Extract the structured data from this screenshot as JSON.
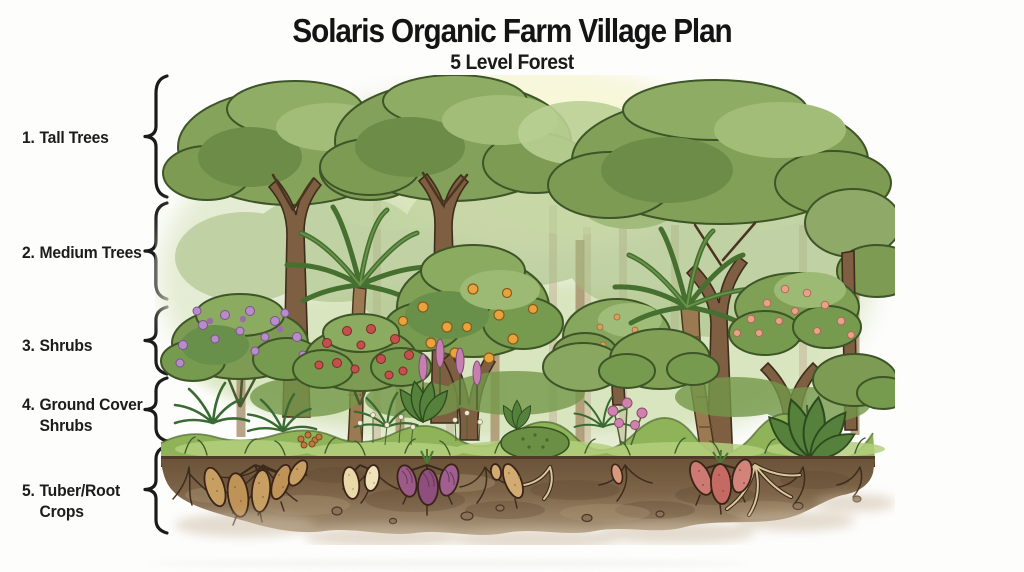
{
  "header": {
    "title": "Solaris Organic Farm Village Plan",
    "subtitle": "5 Level Forest"
  },
  "legend": {
    "items": [
      {
        "number": "1.",
        "lines": [
          "Tall Trees"
        ]
      },
      {
        "number": "2.",
        "lines": [
          "Medium Trees"
        ]
      },
      {
        "number": "3.",
        "lines": [
          "Shrubs"
        ]
      },
      {
        "number": "4.",
        "lines": [
          "Ground Cover",
          "Shrubs"
        ]
      },
      {
        "number": "5.",
        "lines": [
          "Tuber/Root",
          "Crops"
        ]
      }
    ]
  },
  "illustration": {
    "description": "Hand-drawn watercolor cross-section of a five level food forest: tall canopy trees, medium trees with palms and orange fruit tree, flowering shrubs, ferns and ground cover, and underground tuber and root crops in brown soil",
    "layers": [
      "tall-trees",
      "medium-trees",
      "shrubs",
      "ground-cover-shrubs",
      "tuber-root-crops"
    ],
    "palette": {
      "canopy_green": "#86a35c",
      "canopy_dark": "#68904a",
      "canopy_light": "#a2bd78",
      "trunk_brown": "#7e5f41",
      "grass_green": "#8fb359",
      "soil_brown": "#7d6347",
      "flower_purple": "#b78cc8",
      "flower_red": "#c4504e",
      "flower_pink": "#e7a28b",
      "fruit_orange": "#e8a33c",
      "tuber_tan": "#c89f63",
      "tuber_cream": "#ead9a8",
      "tuber_purple": "#8e4f7e",
      "tuber_pink": "#c56a62"
    }
  }
}
